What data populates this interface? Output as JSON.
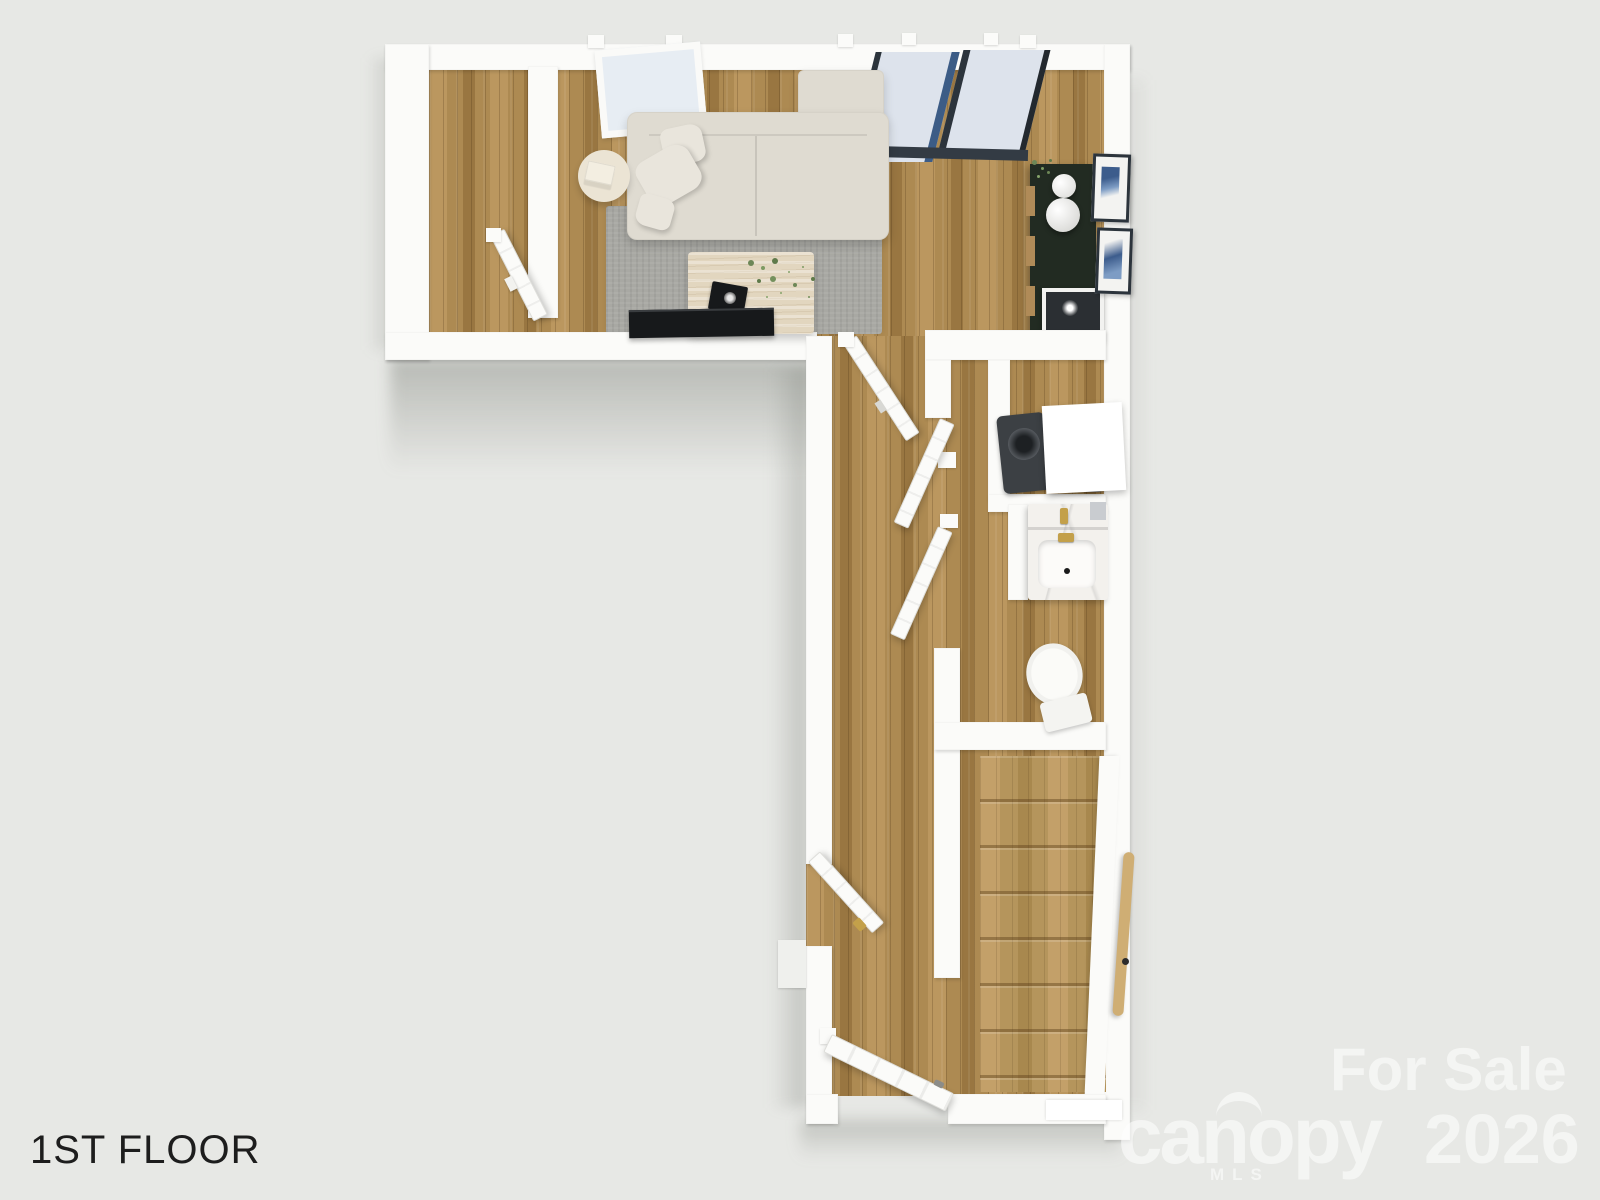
{
  "label": {
    "floor_name": "1ST FLOOR"
  },
  "watermark": {
    "sale": "For Sale",
    "year": "2026",
    "brand": "canopy",
    "brand_sub": "MLS"
  },
  "colors": {
    "background": "#e7e8e5",
    "wall": "#fbfbf9",
    "wood": "#ad8a52",
    "wood_light": "#bb975f",
    "wood_dark": "#997641",
    "rug": "#a8a8a3",
    "sofa": "#dfdbd1",
    "cushion": "#e9e5dc",
    "travertine": "#e2d6bf",
    "side_table": "#ebe4d4",
    "tv": "#17191b",
    "console": "#222b22",
    "shelf_wood": "#b08b58",
    "glass": "#dde3ec",
    "glass_blue": "#3c5c86",
    "frame_dark": "#2c343c",
    "marble": "#f3f1ed",
    "gold": "#c3a04a",
    "porcelain": "#fbfbf8",
    "appliance": "#3c4044",
    "rail": "#cfae74",
    "plant": "#6d8757",
    "art_blue": "#3c5c8c",
    "text": "#1d1d1d",
    "watermark": "rgba(255,255,255,0.55)"
  }
}
